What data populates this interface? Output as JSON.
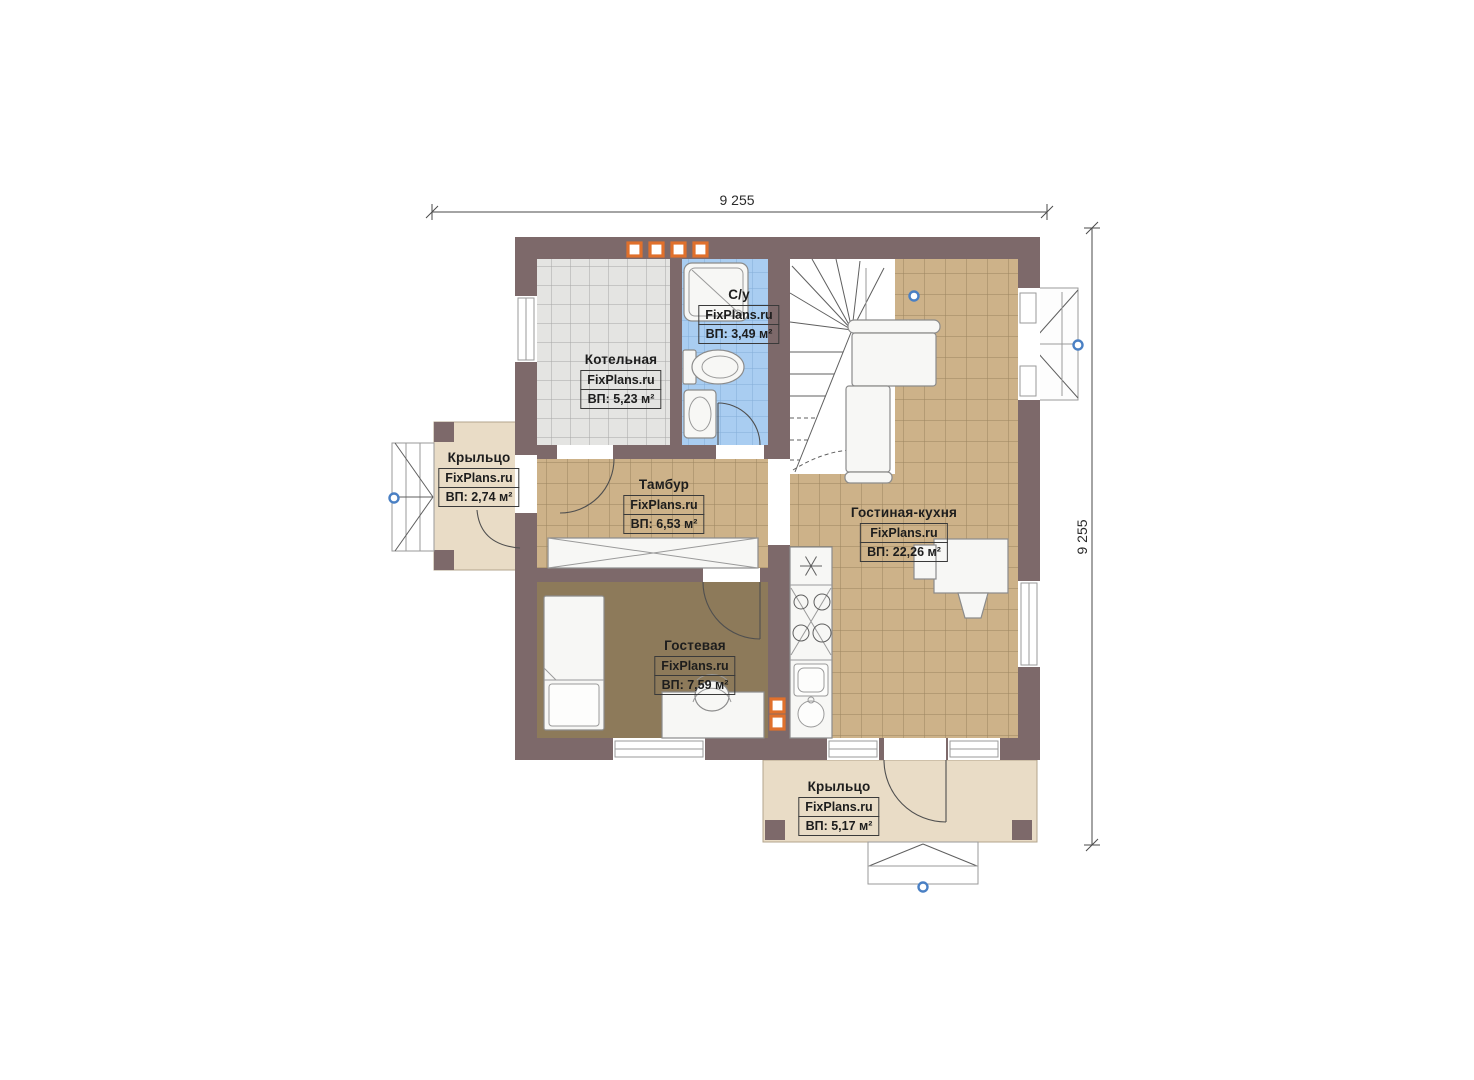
{
  "watermark": "FixPlans.ru",
  "dimensions": {
    "width_label": "9 255",
    "height_label": "9 255"
  },
  "rooms": [
    {
      "name": "Котельная",
      "area_label": "ВП: 5,23 м²"
    },
    {
      "name": "С/у",
      "area_label": "ВП: 3,49 м²"
    },
    {
      "name": "Крыльцо",
      "area_label": "ВП: 2,74 м²"
    },
    {
      "name": "Тамбур",
      "area_label": "ВП: 6,53 м²"
    },
    {
      "name": "Гостиная-кухня",
      "area_label": "ВП: 22,26 м²"
    },
    {
      "name": "Гостевая",
      "area_label": "ВП: 7,59 м²"
    },
    {
      "name": "Крыльцо",
      "area_label": "ВП: 5,17 м²"
    }
  ],
  "colors": {
    "wall": "#7d696a",
    "floor_tile_gray": "#e4e4e2",
    "floor_tile_blue": "#a9cdf1",
    "floor_tile_tan": "#cdb289",
    "floor_guest": "#8d7a5a",
    "porch": "#e9dcc6",
    "vent_orange": "#e0702c",
    "marker_blue": "#4a80c4"
  }
}
